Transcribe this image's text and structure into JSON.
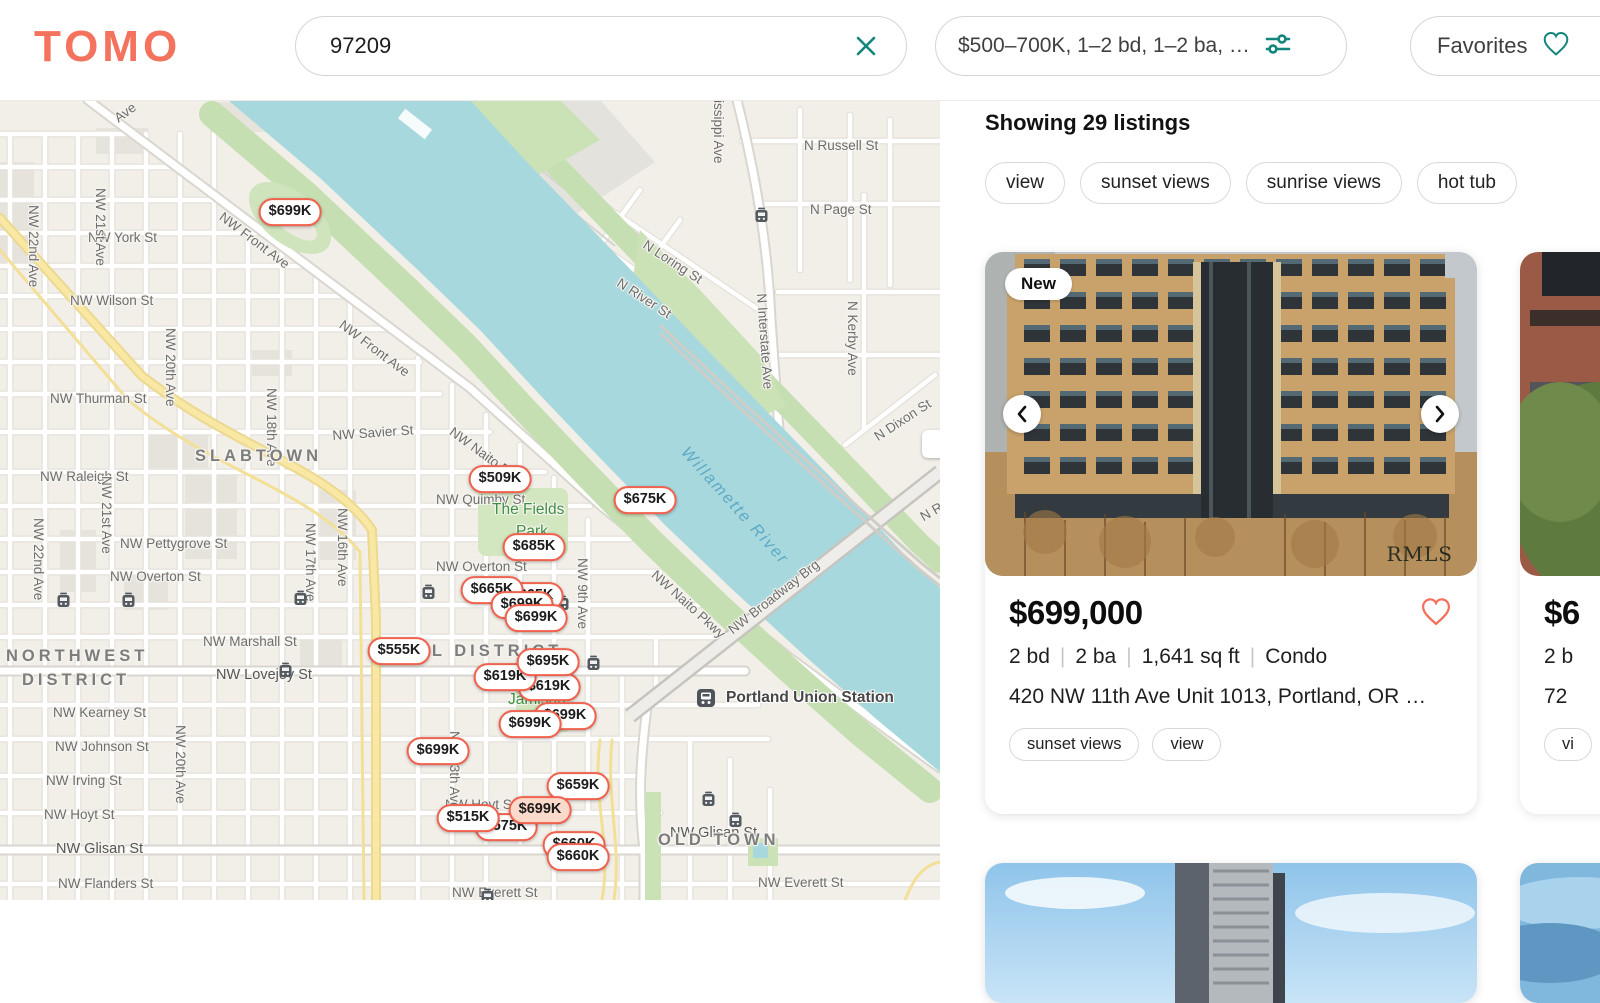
{
  "palette": {
    "coral": "#F4735E",
    "teal": "#12857C",
    "pin_border": "#F0624E",
    "water": "#A7D8DE",
    "park": "#CFE4BA",
    "land": "#F2EFE9",
    "highway": "#F8E8A4"
  },
  "header": {
    "logo": "TOMO",
    "search_value": "97209",
    "filters_label": "$500–700K, 1–2 bd, 1–2 ba, …",
    "favorites_label": "Favorites"
  },
  "map": {
    "labels": [
      {
        "t": "Ave",
        "x": 112,
        "y": 14,
        "r": -36
      },
      {
        "t": "NW York St",
        "x": 88,
        "y": 131
      },
      {
        "t": "NW Wilson St",
        "x": 70,
        "y": 194
      },
      {
        "t": "NW Thurman St",
        "x": 50,
        "y": 292
      },
      {
        "t": "NW Savier St",
        "x": 332,
        "y": 329,
        "r": -4
      },
      {
        "t": "NW Raleigh St",
        "x": 40,
        "y": 370
      },
      {
        "t": "NW Quimby St",
        "x": 436,
        "y": 393
      },
      {
        "t": "NW Pettygrove St",
        "x": 120,
        "y": 437
      },
      {
        "t": "NW Overton St",
        "x": 110,
        "y": 470
      },
      {
        "t": "NW Overton St",
        "x": 436,
        "y": 460
      },
      {
        "t": "NW Marshall St",
        "x": 203,
        "y": 535
      },
      {
        "t": "NW Lovejoy St",
        "x": 216,
        "y": 568,
        "c": "s2"
      },
      {
        "t": "NW Kearney St",
        "x": 53,
        "y": 606
      },
      {
        "t": "NW Johnson St",
        "x": 55,
        "y": 640
      },
      {
        "t": "NW Irving St",
        "x": 46,
        "y": 674
      },
      {
        "t": "NW Hoyt St",
        "x": 44,
        "y": 708
      },
      {
        "t": "NW Glisan St",
        "x": 56,
        "y": 742,
        "c": "s2"
      },
      {
        "t": "NW Flanders St",
        "x": 58,
        "y": 777
      },
      {
        "t": "NW Hoyt St",
        "x": 445,
        "y": 698
      },
      {
        "t": "NW Glisan St",
        "x": 670,
        "y": 726,
        "c": "s2"
      },
      {
        "t": "NW Everett St",
        "x": 758,
        "y": 776
      },
      {
        "t": "NW Everett St",
        "x": 452,
        "y": 786
      },
      {
        "t": "N Russell St",
        "x": 804,
        "y": 39
      },
      {
        "t": "N Page St",
        "x": 810,
        "y": 103
      },
      {
        "t": "N Loring St",
        "x": 648,
        "y": 138,
        "r": 33
      },
      {
        "t": "N River St",
        "x": 622,
        "y": 176,
        "r": 33
      },
      {
        "t": "N Dixon St",
        "x": 872,
        "y": 332,
        "r": -33
      },
      {
        "t": "N R",
        "x": 918,
        "y": 412,
        "r": -30
      },
      {
        "t": "NW 22nd Ave",
        "x": 40,
        "y": 105,
        "r": 90
      },
      {
        "t": "NW 21st Ave",
        "x": 107,
        "y": 88,
        "r": 90
      },
      {
        "t": "NW 20th Ave",
        "x": 177,
        "y": 228,
        "r": 90
      },
      {
        "t": "NW 22nd Ave",
        "x": 45,
        "y": 418,
        "r": 90
      },
      {
        "t": "NW 21st Ave",
        "x": 113,
        "y": 376,
        "r": 90
      },
      {
        "t": "NW 18th Ave",
        "x": 278,
        "y": 288,
        "r": 90
      },
      {
        "t": "NW 17th Ave",
        "x": 317,
        "y": 423,
        "r": 90
      },
      {
        "t": "NW 16th Ave",
        "x": 349,
        "y": 408,
        "r": 90
      },
      {
        "t": "NW 20th Ave",
        "x": 187,
        "y": 625,
        "r": 90
      },
      {
        "t": "NW 13th Ave",
        "x": 461,
        "y": 631,
        "r": 90
      },
      {
        "t": "NW 9th Ave",
        "x": 589,
        "y": 458,
        "r": 90
      },
      {
        "t": "N Interstate Ave",
        "x": 768,
        "y": 193,
        "r": 86
      },
      {
        "t": "N Kerby Ave",
        "x": 859,
        "y": 201,
        "r": 90
      },
      {
        "t": "issippi Ave",
        "x": 725,
        "y": 0,
        "r": 90
      },
      {
        "t": "NW Front Ave",
        "x": 225,
        "y": 110,
        "r": 37
      },
      {
        "t": "NW Front Ave",
        "x": 345,
        "y": 218,
        "r": 37
      },
      {
        "t": "NW Naito Pkwy",
        "x": 455,
        "y": 325,
        "r": 36
      },
      {
        "t": "NW Naito Pkwy",
        "x": 658,
        "y": 468,
        "r": 42
      },
      {
        "t": "NW Broadway Brg",
        "x": 726,
        "y": 526,
        "r": -38
      },
      {
        "t": "SLABTOWN",
        "x": 195,
        "y": 348,
        "c": "district"
      },
      {
        "t": "NORTHWEST",
        "x": 6,
        "y": 548,
        "c": "district"
      },
      {
        "t": "DISTRICT",
        "x": 22,
        "y": 572,
        "c": "district"
      },
      {
        "t": "PEARL DISTRICT",
        "x": 370,
        "y": 543,
        "c": "district"
      },
      {
        "t": "OLD TOWN",
        "x": 658,
        "y": 732,
        "c": "district"
      },
      {
        "t": "The Fields",
        "x": 492,
        "y": 402,
        "c": "park"
      },
      {
        "t": "Park",
        "x": 516,
        "y": 424,
        "c": "park"
      },
      {
        "t": "Jamison",
        "x": 508,
        "y": 592,
        "c": "park"
      },
      {
        "t": "Willamette River",
        "x": 690,
        "y": 344,
        "r": 48,
        "c": "water"
      },
      {
        "t": "Portland Union Station",
        "x": 726,
        "y": 590,
        "c": "poi"
      }
    ],
    "transit": [
      [
        63,
        500
      ],
      [
        128,
        500
      ],
      [
        300,
        498
      ],
      [
        428,
        492
      ],
      [
        562,
        503
      ],
      [
        593,
        563
      ],
      [
        285,
        570
      ],
      [
        708,
        699
      ],
      [
        735,
        720
      ],
      [
        761,
        115
      ],
      [
        487,
        796
      ]
    ],
    "station_icon": {
      "x": 706,
      "y": 598
    },
    "pins": [
      {
        "t": "$699K",
        "x": 290,
        "y": 112
      },
      {
        "t": "$509K",
        "x": 500,
        "y": 379
      },
      {
        "t": "$675K",
        "x": 645,
        "y": 400
      },
      {
        "t": "$685K",
        "x": 534,
        "y": 447
      },
      {
        "t": "$665K",
        "x": 492,
        "y": 490,
        "g": {
          "dx": 40,
          "dy": 6
        }
      },
      {
        "t": "$699K",
        "x": 536,
        "y": 518,
        "g": {
          "dx": -14,
          "dy": -13
        }
      },
      {
        "t": "$555K",
        "x": 399,
        "y": 551
      },
      {
        "t": "$619K",
        "x": 505,
        "y": 577,
        "g": {
          "dx": 44,
          "dy": 10
        }
      },
      {
        "t": "$695K",
        "x": 548,
        "y": 562
      },
      {
        "t": "$699K",
        "x": 530,
        "y": 624,
        "g": {
          "dx": 35,
          "dy": -8
        }
      },
      {
        "t": "$699K",
        "x": 438,
        "y": 651
      },
      {
        "t": "$659K",
        "x": 578,
        "y": 686
      },
      {
        "t": "$515K",
        "x": 468,
        "y": 718,
        "g": {
          "dx": 38,
          "dy": 9,
          "t": "$575K"
        }
      },
      {
        "t": "$699K",
        "x": 540,
        "y": 710,
        "sel": true
      },
      {
        "t": "$660K",
        "x": 578,
        "y": 757,
        "g": {
          "dx": -4,
          "dy": -12
        }
      }
    ]
  },
  "results": {
    "heading": "Showing 29 listings",
    "chips": [
      "view",
      "sunset views",
      "sunrise views",
      "hot tub"
    ],
    "card": {
      "badge": "New",
      "price": "$699,000",
      "specs": [
        "2 bd",
        "2 ba",
        "1,641 sq ft",
        "Condo"
      ],
      "address": "420 NW 11th Ave Unit 1013, Portland, OR …",
      "tags": [
        "sunset views",
        "view"
      ],
      "watermark": "RMLS"
    },
    "partial_card": {
      "price": "$6",
      "specs": "2 b",
      "address": "72",
      "tag": "vi"
    }
  }
}
